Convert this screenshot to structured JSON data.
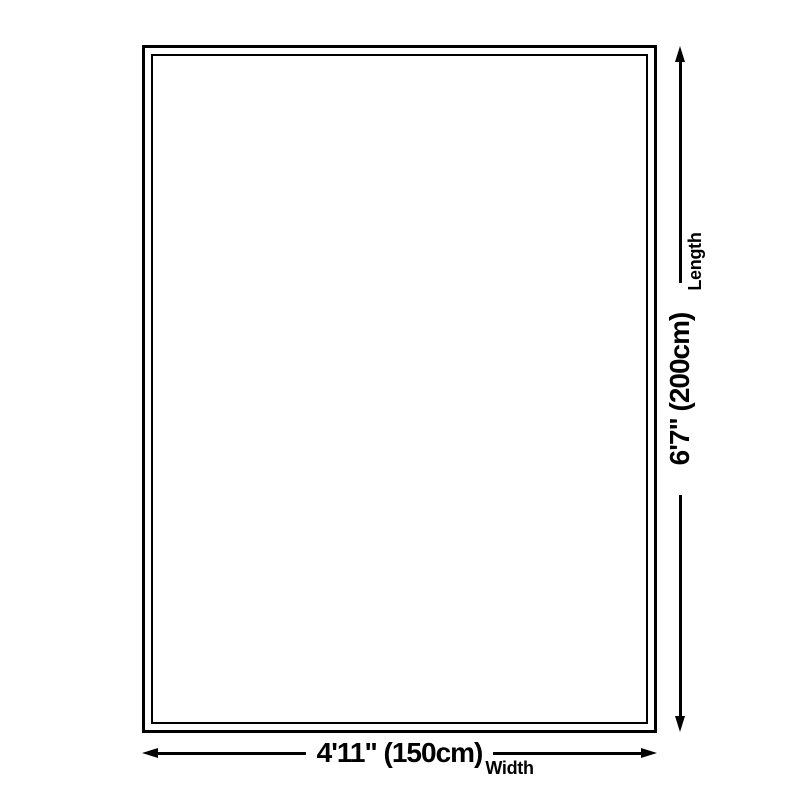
{
  "colors": {
    "background": "#ffffff",
    "line": "#000000",
    "text": "#000000"
  },
  "diagram": {
    "type": "product-size-diagram",
    "dimensions": {
      "width": {
        "value": "4'11\" (150cm)",
        "axis_label": "Width"
      },
      "length": {
        "value": "6'7\" (200cm)",
        "axis_label": "Length"
      }
    }
  }
}
